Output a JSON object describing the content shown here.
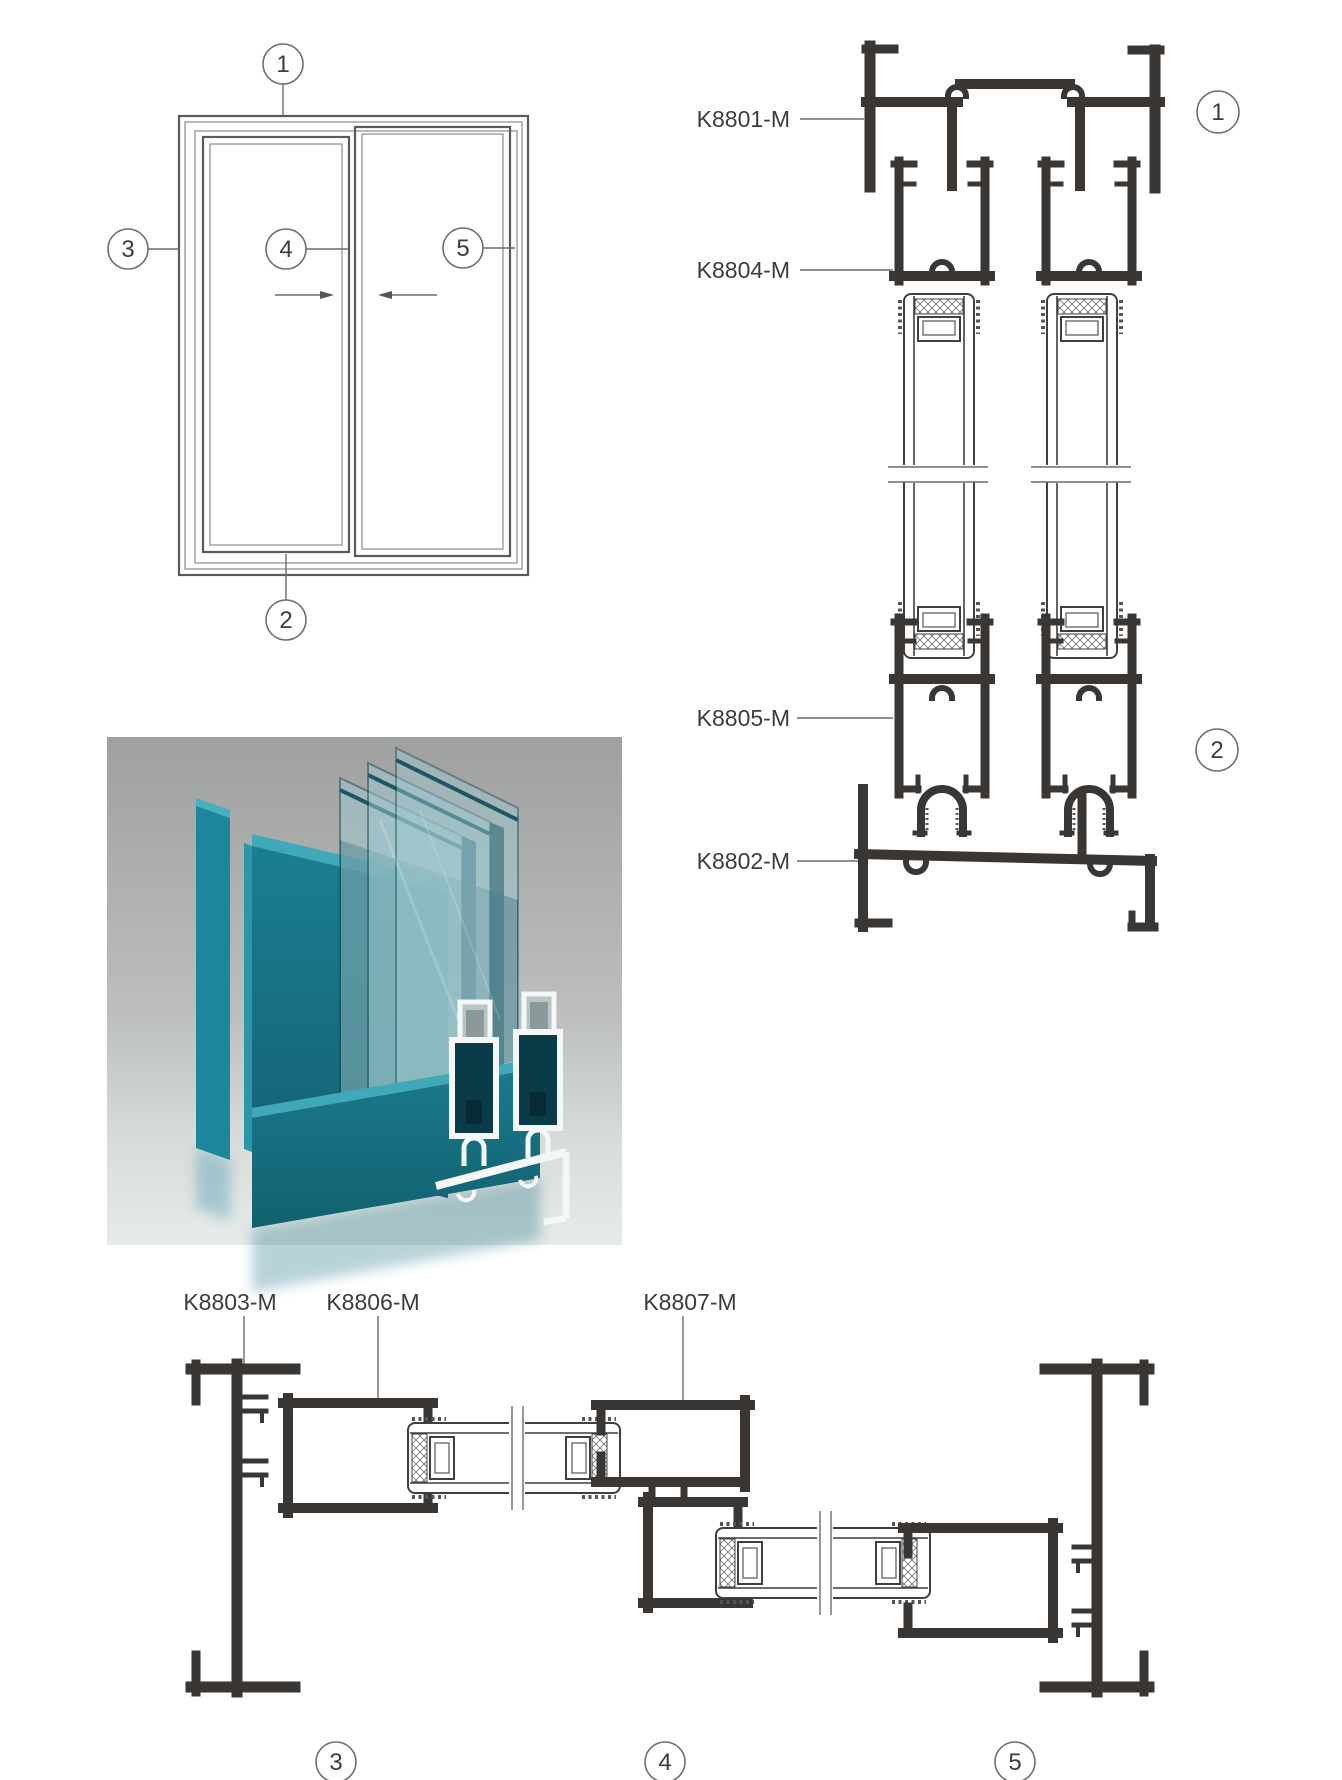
{
  "part_labels": {
    "head_frame": "K8801-M",
    "sill_frame": "K8802-M",
    "side_jamb": "K8803-M",
    "top_sash_rail": "K8804-M",
    "bottom_sash_rail": "K8805-M",
    "sash_side_stile": "K8806-M",
    "meeting_stile": "K8807-M"
  },
  "section_markers": {
    "m1": "1",
    "m2": "2",
    "m3": "3",
    "m4": "4",
    "m5": "5"
  },
  "colors": {
    "profile_line": "#3a3633",
    "leader_line": "#6b6b6b",
    "render_teal": "#16707f",
    "render_teal_light": "#3fa9b9",
    "render_teal_dark": "#0a3b48",
    "render_background_top": "#9fa0a0",
    "render_background_bottom": "#e6eae9",
    "page_background": "#ffffff"
  }
}
